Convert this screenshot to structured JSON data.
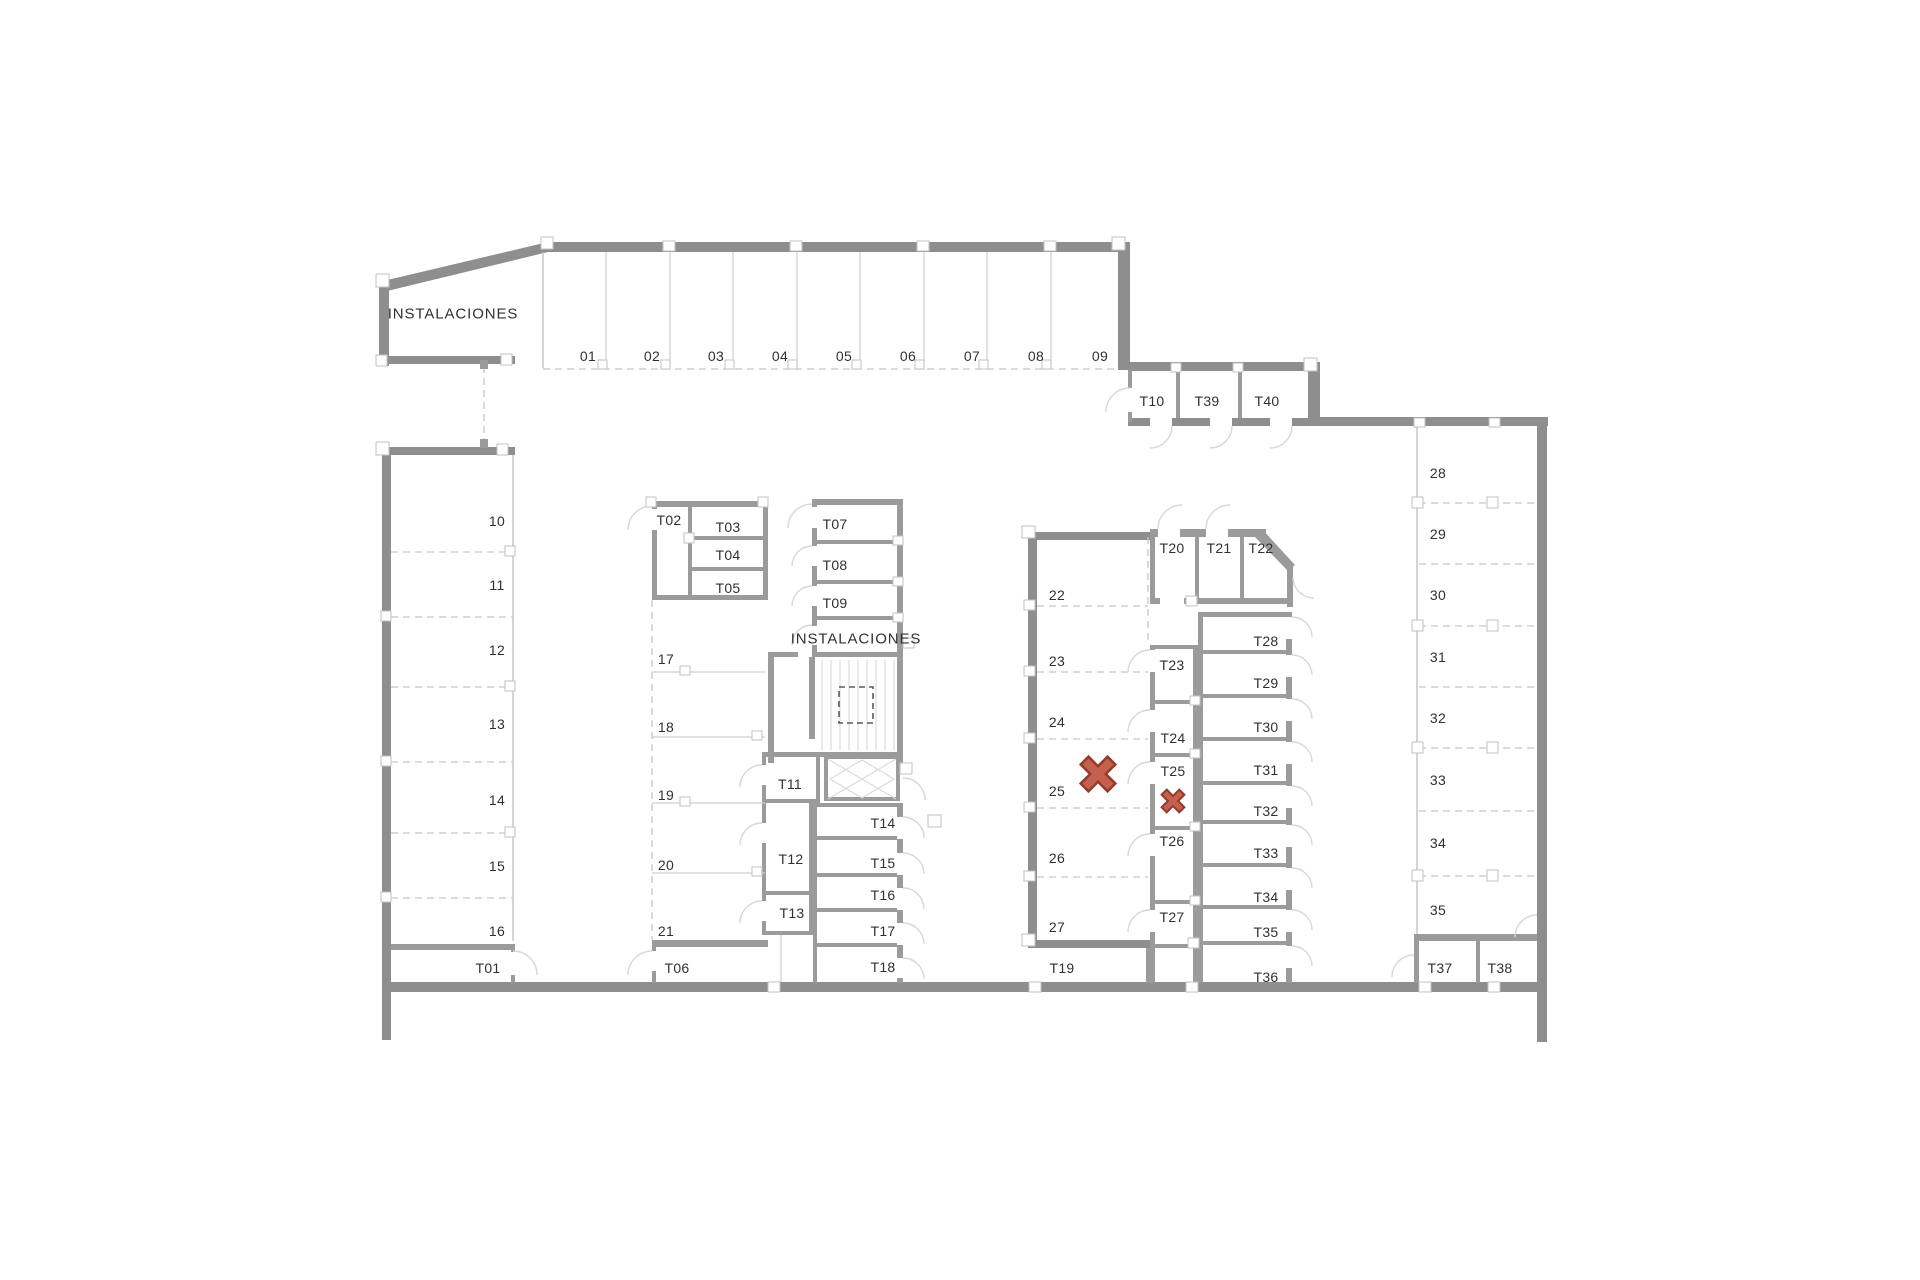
{
  "colors": {
    "wall": "#8e8e8e",
    "marker_fill": "#c4604e",
    "marker_stroke": "#943a2c",
    "text": "#303030"
  },
  "rooms": {
    "instalaciones_upper": "INSTALACIONES",
    "instalaciones_middle": "INSTALACIONES"
  },
  "icons": {
    "large_x": "x-cross-marker",
    "small_x": "x-cross-marker"
  },
  "parking": {
    "top_row": [
      "01",
      "02",
      "03",
      "04",
      "05",
      "06",
      "07",
      "08",
      "09"
    ],
    "left_column": [
      "10",
      "11",
      "12",
      "13",
      "14",
      "15",
      "16"
    ],
    "inner_left_column": [
      "17",
      "18",
      "19",
      "20",
      "21"
    ],
    "center_column": [
      "22",
      "23",
      "24",
      "25",
      "26",
      "27"
    ],
    "right_column": [
      "28",
      "29",
      "30",
      "31",
      "32",
      "33",
      "34",
      "35"
    ]
  },
  "storage": {
    "t01": "T01",
    "t02": "T02",
    "t03": "T03",
    "t04": "T04",
    "t05": "T05",
    "t06": "T06",
    "t07": "T07",
    "t08": "T08",
    "t09": "T09",
    "t10": "T10",
    "t11": "T11",
    "t12": "T12",
    "t13": "T13",
    "t14": "T14",
    "t15": "T15",
    "t16": "T16",
    "t17": "T17",
    "t18": "T18",
    "t19": "T19",
    "t20": "T20",
    "t21": "T21",
    "t22": "T22",
    "t23": "T23",
    "t24": "T24",
    "t25": "T25",
    "t26": "T26",
    "t27": "T27",
    "t28": "T28",
    "t29": "T29",
    "t30": "T30",
    "t31": "T31",
    "t32": "T32",
    "t33": "T33",
    "t34": "T34",
    "t35": "T35",
    "t36": "T36",
    "t37": "T37",
    "t38": "T38",
    "t39": "T39",
    "t40": "T40"
  }
}
